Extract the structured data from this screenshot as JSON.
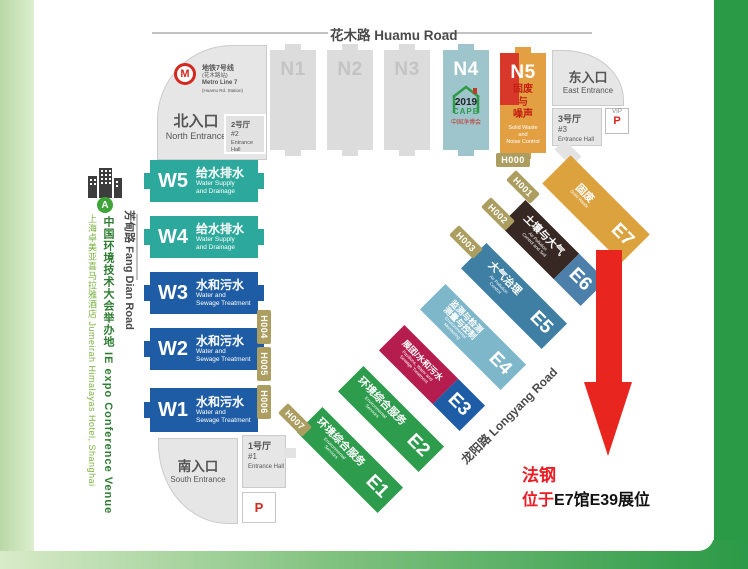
{
  "colors": {
    "accent_green": "#2B9A47",
    "sidebar_green": "#B9D8A6",
    "teal_hall": "#2CA89C",
    "blue_hall": "#1E5CA5",
    "gray_hall": "#DCDCDC",
    "n4_hall": "#9EC4CC",
    "n5_orange": "#E2A042",
    "n5_red": "#D8382A",
    "green_hall": "#2E9C4D",
    "e3_crimson": "#B51D4E",
    "e4_lightblue": "#7EB7CA",
    "e5_steelblue": "#3E7FA3",
    "e6_brown": "#382823",
    "e6_blue": "#4C80AB",
    "e7_orange": "#DBA23E",
    "gate_olive": "#AC9E60",
    "arrow_red": "#E8251F"
  },
  "sidebar": {
    "marker": "A",
    "venue": "中国环境技术大会举办地 IE expo Conference Venue",
    "hotel": "上海卓美亚喜马拉雅酒店 Jumeirah Himalayas Hotel, Shanghai"
  },
  "roads": {
    "huamu": "花木路 Huamu Road",
    "fangdian": "芳甸路 Fang Dian Road",
    "longyang": "龙阳路 Longyang Road"
  },
  "metro": {
    "logo_letter": "M",
    "line_zh": "地铁7号线",
    "station_zh": "(花木路站)",
    "line_en": "Metro Line 7",
    "station_en": "(Huamu Rd. Station)"
  },
  "entrances": {
    "north_zh": "北入口",
    "north_en": "North Entrance",
    "east_zh": "东入口",
    "east_en": "East Entrance",
    "south_zh": "南入口",
    "south_en": "South Entrance"
  },
  "entrance_halls": {
    "h1_zh": "1号厅",
    "h1_no": "#1",
    "h1_en": "Entrance Hall",
    "h2_zh": "2号厅",
    "h2_no": "#2",
    "h2_en": "Entrance Hall",
    "h3_zh": "3号厅",
    "h3_no": "#3",
    "h3_en": "Entrance Hall"
  },
  "parking": {
    "vip": "VIP",
    "p": "P"
  },
  "cape": {
    "year": "2019",
    "name": "CAPE",
    "zh": "中国净博会"
  },
  "halls": {
    "n1": "N1",
    "n2": "N2",
    "n3": "N3",
    "n4": "N4",
    "n5": {
      "code": "N5",
      "zh1": "固废",
      "zh2": "与",
      "zh3": "噪声",
      "en1": "Solid Waste",
      "en2": "and",
      "en3": "Noise Control"
    },
    "w5": {
      "code": "W5",
      "zh": "给水排水",
      "en1": "Water Supply",
      "en2": "and Drainage"
    },
    "w4": {
      "code": "W4",
      "zh": "给水排水",
      "en1": "Water Supply",
      "en2": "and Drainage"
    },
    "w3": {
      "code": "W3",
      "zh": "水和污水",
      "en1": "Water and",
      "en2": "Sewage Treatment"
    },
    "w2": {
      "code": "W2",
      "zh": "水和污水",
      "en1": "Water and",
      "en2": "Sewage Treatment"
    },
    "w1": {
      "code": "W1",
      "zh": "水和污水",
      "en1": "Water and",
      "en2": "Sewage Treatment"
    },
    "e1": {
      "code": "E1",
      "zh": "环境综合服务",
      "en1": "Environmental",
      "en2": "Services"
    },
    "e2": {
      "code": "E2",
      "zh": "环境综合服务",
      "en1": "Environmental",
      "en2": "Services"
    },
    "e3": {
      "code": "E3",
      "zh": "展团/水和污水",
      "en1": "Pavilions, Water and",
      "en2": "Sewage Treatment"
    },
    "e4": {
      "code": "E4",
      "zh1": "监测与检测",
      "zh2": "测量与控制",
      "en1": "Environmental",
      "en2": "Monitoring"
    },
    "e5": {
      "code": "E5",
      "zh": "大气治理",
      "en1": "Air Pollution",
      "en2": "Control"
    },
    "e6": {
      "code": "E6",
      "zh": "土壤与大气",
      "en1": "Air Pollution",
      "en2": "Control and Soil"
    },
    "e7": {
      "code": "E7",
      "zh": "固废",
      "en": "Solid Waste"
    }
  },
  "gates": {
    "g0": "H000",
    "g1": "H001",
    "g2": "H002",
    "g3": "H003",
    "g4": "H004",
    "g5": "H005",
    "g6": "H006",
    "g7": "H007"
  },
  "annotation": {
    "company": "法钢",
    "prefix": "位于",
    "booth": "E7馆E39展位"
  }
}
